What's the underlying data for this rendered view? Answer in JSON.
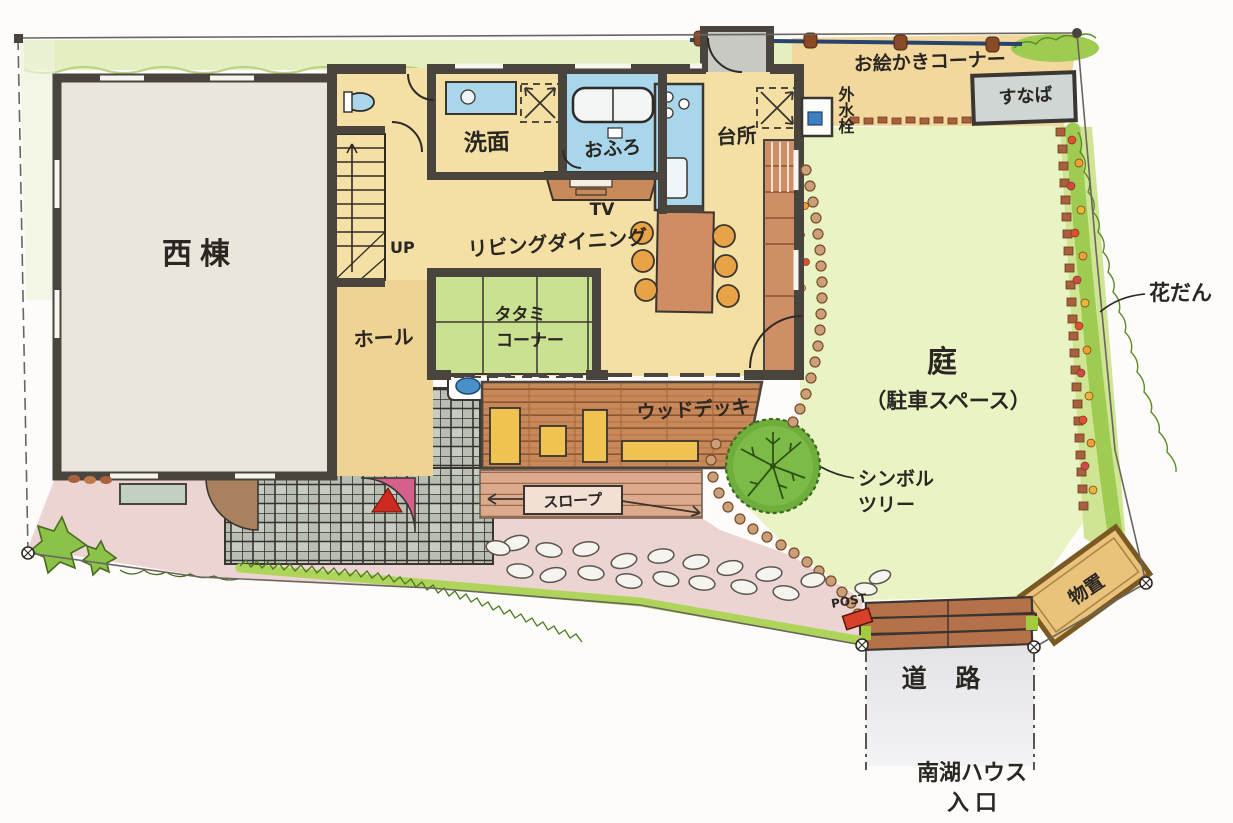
{
  "plan": {
    "house": {
      "west_wing": "西棟",
      "washroom": "洗面",
      "bath": "おふろ",
      "kitchen": "台所",
      "tv": "TV",
      "living_dining": "リビングダイニング",
      "stairs_up": "UP",
      "hall": "ホール",
      "tatami_line1": "タタミ",
      "tatami_line2": "コーナー",
      "wood_deck": "ウッドデッキ",
      "slope": "スロープ"
    },
    "site": {
      "drawing_corner": "お絵かきコーナー",
      "sandbox": "すなば",
      "outdoor_faucet": "外水栓",
      "garden_line1": "庭",
      "garden_line2": "（駐車スペース）",
      "flower_bed": "花だん",
      "symbol_tree_line1": "シンボル",
      "symbol_tree_line2": "ツリー",
      "shed": "物置",
      "post": "POST",
      "road": "道 路",
      "entrance_line1": "南湖ハウス",
      "entrance_line2": "入口"
    },
    "colors": {
      "wall": "#4a443e",
      "floor_tan": "#f4dfa4",
      "hall_tan": "#eed394",
      "tatami_green": "#c9e190",
      "bath_blue": "#a9d6ea",
      "deck_brown": "#c8895a",
      "tile_gray": "#b9beb4",
      "approach_pink": "#ecd4d2",
      "garden_green": "#eaf3c4",
      "bed_green": "#9ecc52",
      "shed_tan": "#e9c27b",
      "road_gray": "#e8e8ea",
      "fence_navy": "#27436e",
      "door_pink": "#d65f8c",
      "post_red": "#d84028"
    }
  }
}
